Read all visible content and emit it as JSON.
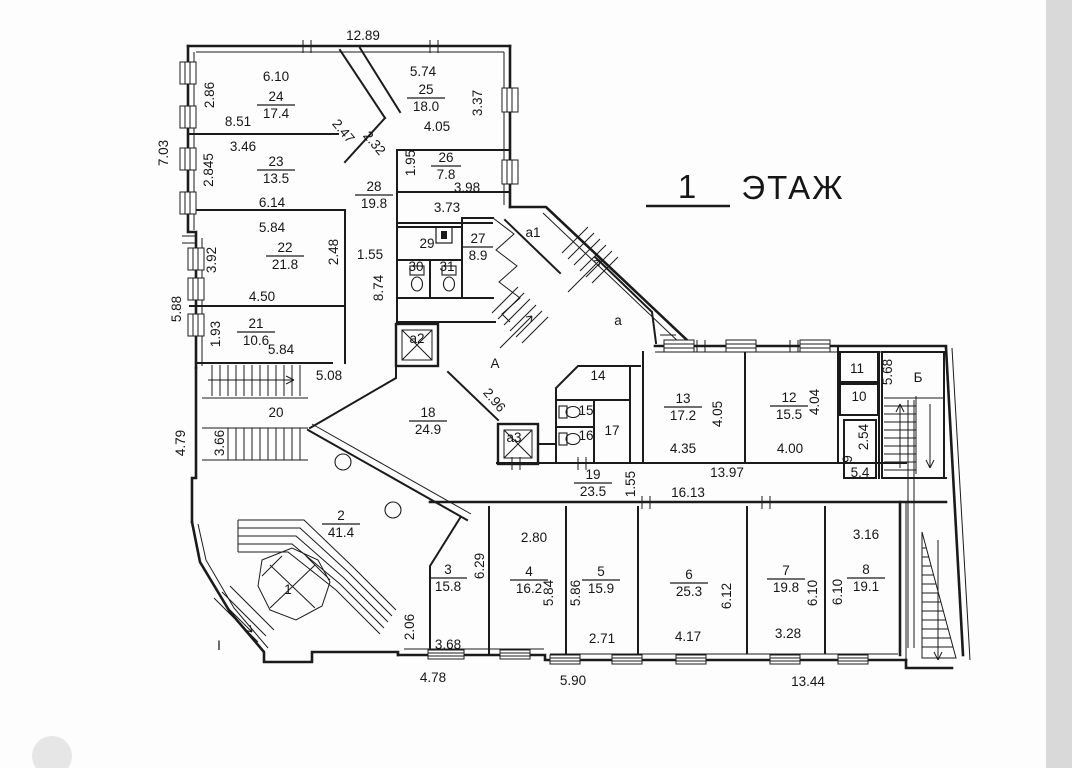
{
  "meta": {
    "ink": "#1b1b1b",
    "paper": "#ffffff",
    "scan_edge": "#d9d9d9"
  },
  "title": {
    "number": "1",
    "word": "ЭТАЖ"
  },
  "plan": {
    "room_areas": [
      {
        "n": "24",
        "a": "17.4",
        "x": 276,
        "y": 104
      },
      {
        "n": "25",
        "a": "18.0",
        "x": 426,
        "y": 97
      },
      {
        "n": "23",
        "a": "13.5",
        "x": 276,
        "y": 169
      },
      {
        "n": "26",
        "a": "7.8",
        "x": 446,
        "y": 165
      },
      {
        "n": "28",
        "a": "19.8",
        "x": 374,
        "y": 194
      },
      {
        "n": "22",
        "a": "21.8",
        "x": 285,
        "y": 255
      },
      {
        "n": "27",
        "a": "8.9",
        "x": 478,
        "y": 246
      },
      {
        "n": "21",
        "a": "10.6",
        "x": 256,
        "y": 331
      },
      {
        "n": "18",
        "a": "24.9",
        "x": 428,
        "y": 420
      },
      {
        "n": "2",
        "a": "41.4",
        "x": 341,
        "y": 523
      },
      {
        "n": "19",
        "a": "23.5",
        "x": 593,
        "y": 482
      },
      {
        "n": "13",
        "a": "17.2",
        "x": 683,
        "y": 406
      },
      {
        "n": "12",
        "a": "15.5",
        "x": 789,
        "y": 405
      },
      {
        "n": "3",
        "a": "15.8",
        "x": 448,
        "y": 577
      },
      {
        "n": "4",
        "a": "16.2",
        "x": 529,
        "y": 579
      },
      {
        "n": "5",
        "a": "15.9",
        "x": 601,
        "y": 579
      },
      {
        "n": "6",
        "a": "25.3",
        "x": 689,
        "y": 582
      },
      {
        "n": "7",
        "a": "19.8",
        "x": 786,
        "y": 578
      },
      {
        "n": "8",
        "a": "19.1",
        "x": 866,
        "y": 577
      }
    ],
    "room_numbers": [
      {
        "t": "29",
        "x": 427,
        "y": 248
      },
      {
        "t": "30",
        "x": 416,
        "y": 271
      },
      {
        "t": "31",
        "x": 447,
        "y": 271
      },
      {
        "t": "14",
        "x": 598,
        "y": 380
      },
      {
        "t": "15",
        "x": 586,
        "y": 415
      },
      {
        "t": "16",
        "x": 586,
        "y": 440
      },
      {
        "t": "17",
        "x": 612,
        "y": 435
      },
      {
        "t": "11",
        "x": 857,
        "y": 373
      },
      {
        "t": "10",
        "x": 859,
        "y": 401
      },
      {
        "t": "1",
        "x": 288,
        "y": 594
      },
      {
        "t": "20",
        "x": 276,
        "y": 417,
        "s": 15
      },
      {
        "t": "I",
        "x": 219,
        "y": 650,
        "s": 16
      },
      {
        "t": "А",
        "x": 495,
        "y": 368,
        "s": 16
      },
      {
        "t": "а",
        "x": 618,
        "y": 325,
        "s": 15
      },
      {
        "t": "а1",
        "x": 533,
        "y": 237
      },
      {
        "t": "а2",
        "x": 417,
        "y": 343
      },
      {
        "t": "а3",
        "x": 514,
        "y": 442
      },
      {
        "t": "Б",
        "x": 918,
        "y": 382,
        "s": 15
      }
    ],
    "dims_h": [
      {
        "t": "12.89",
        "x": 363,
        "y": 40
      },
      {
        "t": "6.10",
        "x": 276,
        "y": 81
      },
      {
        "t": "5.74",
        "x": 423,
        "y": 76
      },
      {
        "t": "8.51",
        "x": 238,
        "y": 126
      },
      {
        "t": "4.05",
        "x": 437,
        "y": 131
      },
      {
        "t": "3.46",
        "x": 243,
        "y": 151
      },
      {
        "t": "6.14",
        "x": 272,
        "y": 207
      },
      {
        "t": "3.98",
        "x": 467,
        "y": 192
      },
      {
        "t": "3.73",
        "x": 447,
        "y": 212
      },
      {
        "t": "5.84",
        "x": 272,
        "y": 232
      },
      {
        "t": "1.55",
        "x": 370,
        "y": 259
      },
      {
        "t": "4.50",
        "x": 262,
        "y": 301
      },
      {
        "t": "5.84",
        "x": 281,
        "y": 354
      },
      {
        "t": "5.08",
        "x": 329,
        "y": 380
      },
      {
        "t": "2.80",
        "x": 534,
        "y": 542
      },
      {
        "t": "3.16",
        "x": 866,
        "y": 539
      },
      {
        "t": "13.97",
        "x": 727,
        "y": 477
      },
      {
        "t": "16.13",
        "x": 688,
        "y": 497
      },
      {
        "t": "4.35",
        "x": 683,
        "y": 453
      },
      {
        "t": "4.00",
        "x": 790,
        "y": 453
      },
      {
        "t": "5.4",
        "x": 860,
        "y": 477
      },
      {
        "t": "2.71",
        "x": 602,
        "y": 643
      },
      {
        "t": "4.17",
        "x": 688,
        "y": 641
      },
      {
        "t": "3.28",
        "x": 788,
        "y": 638
      },
      {
        "t": "3.68",
        "x": 448,
        "y": 649
      },
      {
        "t": "4.78",
        "x": 433,
        "y": 682
      },
      {
        "t": "5.90",
        "x": 573,
        "y": 685
      },
      {
        "t": "13.44",
        "x": 808,
        "y": 686
      }
    ],
    "dims_v": [
      {
        "t": "7.03",
        "x": 168,
        "y": 153
      },
      {
        "t": "5.88",
        "x": 181,
        "y": 309
      },
      {
        "t": "2.86",
        "x": 214,
        "y": 95
      },
      {
        "t": "2.845",
        "x": 213,
        "y": 170
      },
      {
        "t": "3.92",
        "x": 216,
        "y": 260
      },
      {
        "t": "1.93",
        "x": 220,
        "y": 334
      },
      {
        "t": "4.79",
        "x": 185,
        "y": 443
      },
      {
        "t": "3.66",
        "x": 224,
        "y": 443
      },
      {
        "t": "3.37",
        "x": 482,
        "y": 103
      },
      {
        "t": "1.95",
        "x": 415,
        "y": 163
      },
      {
        "t": "2.48",
        "x": 338,
        "y": 252
      },
      {
        "t": "8.74",
        "x": 383,
        "y": 288
      },
      {
        "t": "6.29",
        "x": 484,
        "y": 566
      },
      {
        "t": "2.06",
        "x": 414,
        "y": 627
      },
      {
        "t": "5.84",
        "x": 553,
        "y": 593
      },
      {
        "t": "5.86",
        "x": 580,
        "y": 593
      },
      {
        "t": "6.12",
        "x": 731,
        "y": 596
      },
      {
        "t": "6.10",
        "x": 817,
        "y": 593
      },
      {
        "t": "6.10",
        "x": 842,
        "y": 592
      },
      {
        "t": "4.05",
        "x": 722,
        "y": 414
      },
      {
        "t": "4.04",
        "x": 819,
        "y": 402
      },
      {
        "t": "5.68",
        "x": 892,
        "y": 372
      },
      {
        "t": "2.54",
        "x": 868,
        "y": 437
      },
      {
        "t": "1.55",
        "x": 635,
        "y": 484
      },
      {
        "t": "9",
        "x": 852,
        "y": 459
      }
    ],
    "dims_diag": [
      {
        "t": "2.47",
        "x": 340,
        "y": 134,
        "r": 50
      },
      {
        "t": "2.32",
        "x": 371,
        "y": 146,
        "r": 50
      },
      {
        "t": "2.96",
        "x": 491,
        "y": 403,
        "r": 50
      }
    ]
  }
}
